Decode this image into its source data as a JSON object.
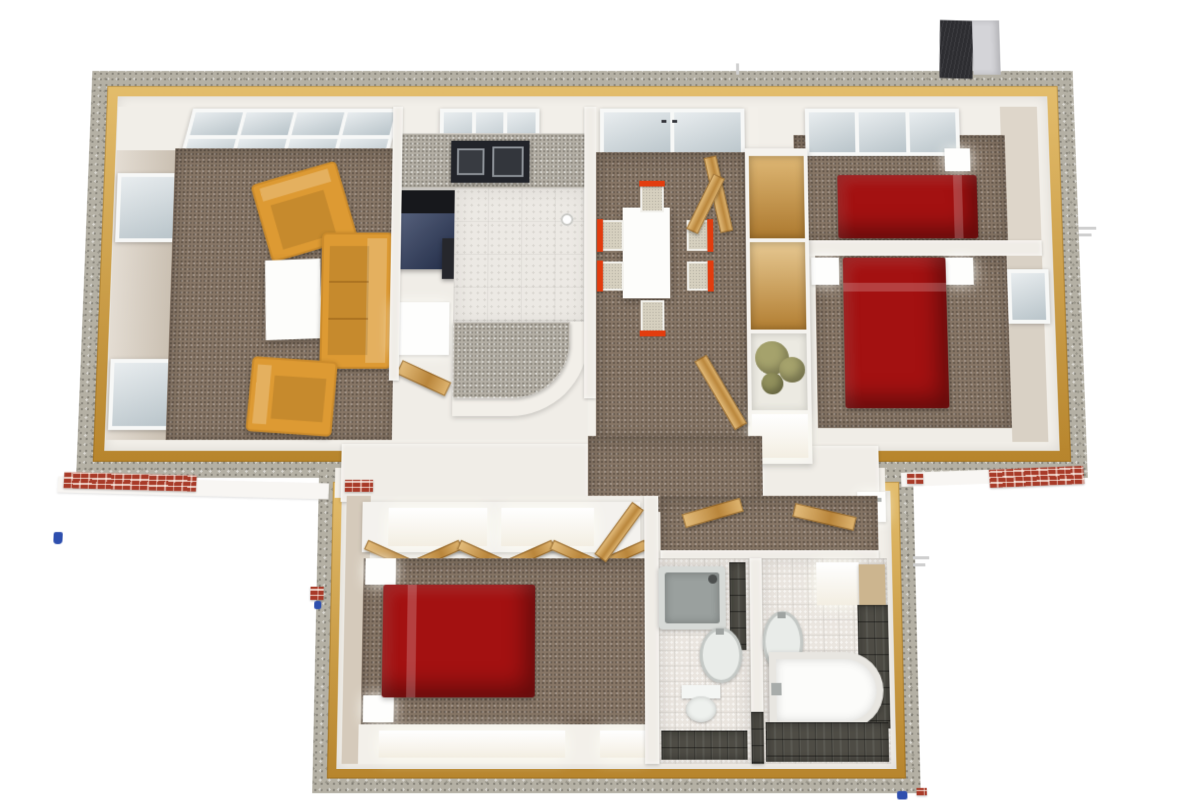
{
  "scene": {
    "title": "Bird's-eye 3D rendering of a furnished single-storey house floor plan",
    "background": "#ffffff"
  },
  "colors": {
    "wall_speckle": "#b4b0a4",
    "wall_trim_gold": "#cc9838",
    "interior_wall": "#f0ede7",
    "wall_face_tan": "#d5cabb",
    "carpet": "#877666",
    "kitchen_tile": "#ece9e4",
    "granite": "#b3aea4",
    "counter_white": "#f2efe9",
    "stove_black": "#22242a",
    "appliance_navy": "#2c3a5e",
    "sofa_orange": "#dd9a33",
    "bed_red": "#a31111",
    "table_white": "#fdfdfb",
    "chair_red": "#e23c0e",
    "chair_seat": "#d6d0bf",
    "wood_door": "#cf9b4c",
    "closet_wood": "#c8913d",
    "green_storage": "#a5a26c",
    "bath_tile_light": "#eae5df",
    "bath_tile_dark": "#4e4c45",
    "shower_gray": "#9aa09e",
    "fixture_white": "#fcfcfa",
    "brick_red": "#a83a28",
    "chimney_dark": "#2d2d31",
    "chimney_light": "#d4d4d8",
    "window_glass": "#cdd7dc",
    "marker_blue": "#2e4fae"
  },
  "rooms": [
    {
      "id": "living-room",
      "label": "Living room",
      "furniture": [
        "orange sofa",
        "two orange armchairs",
        "white coffee table"
      ]
    },
    {
      "id": "kitchen",
      "label": "Kitchen",
      "furniture": [
        "granite counter with stove",
        "navy appliance",
        "white cabinet",
        "curved granite peninsula"
      ]
    },
    {
      "id": "dining-area",
      "label": "Dining area",
      "furniture": [
        "white table",
        "six red-backed chairs"
      ]
    },
    {
      "id": "bedroom-top-right",
      "label": "Bedroom (top right)",
      "furniture": [
        "red double bed",
        "nightstand"
      ]
    },
    {
      "id": "bedroom-right",
      "label": "Bedroom (right)",
      "furniture": [
        "red double bed",
        "two nightstands"
      ]
    },
    {
      "id": "bedroom-wing",
      "label": "Bedroom (bottom wing)",
      "furniture": [
        "red double bed",
        "two nightstands",
        "closet with bifold wooden doors"
      ]
    },
    {
      "id": "shower-room",
      "label": "Shower room",
      "furniture": [
        "shower tray",
        "washbasin",
        "toilet"
      ]
    },
    {
      "id": "bathroom",
      "label": "Bathroom",
      "furniture": [
        "bathtub",
        "washbasin"
      ]
    },
    {
      "id": "hallway",
      "label": "Hallway",
      "furniture": [
        "shelving unit with green storage",
        "open wooden doors"
      ]
    }
  ],
  "exterior": {
    "features": [
      "chimney",
      "brick base courses",
      "speckled wall tops with golden trim",
      "blue survey markers"
    ]
  }
}
